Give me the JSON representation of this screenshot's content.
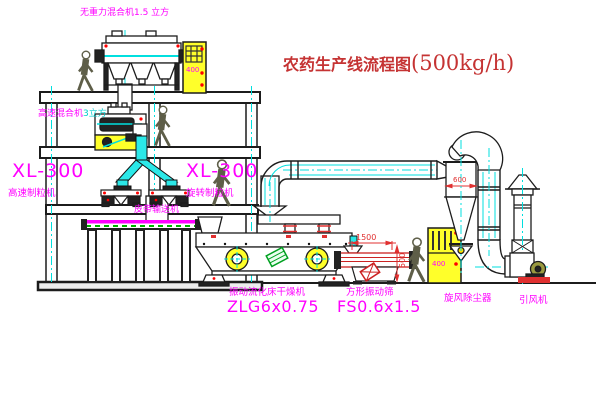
{
  "title": {
    "main": "农药生产线流程图",
    "capacity": "(500kg/h)"
  },
  "eq": {
    "top_mixer": "无重力混合机1.5 立方",
    "floor2_mixer_name": "高速混合机",
    "floor2_mixer_size": "3立方",
    "gran_left_model": "XL-300",
    "gran_left_name": "高速制粒机",
    "gran_right_model": "XL-300",
    "gran_right_name": "旋转制粒机",
    "belt": "皮带输送机",
    "dryer_name": "振动流化床干燥机",
    "dryer_model": "ZLG6x0.75",
    "screen_name": "方形振动筛",
    "screen_model": "FS0.6x1.5",
    "cyclone": "旋风除尘器",
    "fan": "引风机"
  },
  "dims": {
    "screen_length": "1500",
    "screen_side": "500",
    "cyclone_diameter": "600"
  },
  "marks": {
    "cabinet1": "400",
    "cabinet2": "400"
  },
  "colors": {
    "label_magenta": "#ff00ff",
    "title_red": "#c53333",
    "line_black": "#1c1c1c",
    "pipe_cyan": "#00e0e0",
    "fill_yellow": "#ffff2a",
    "accent_red": "#ff0000",
    "conveyor_green": "#00b400",
    "background": "#ffffff"
  }
}
